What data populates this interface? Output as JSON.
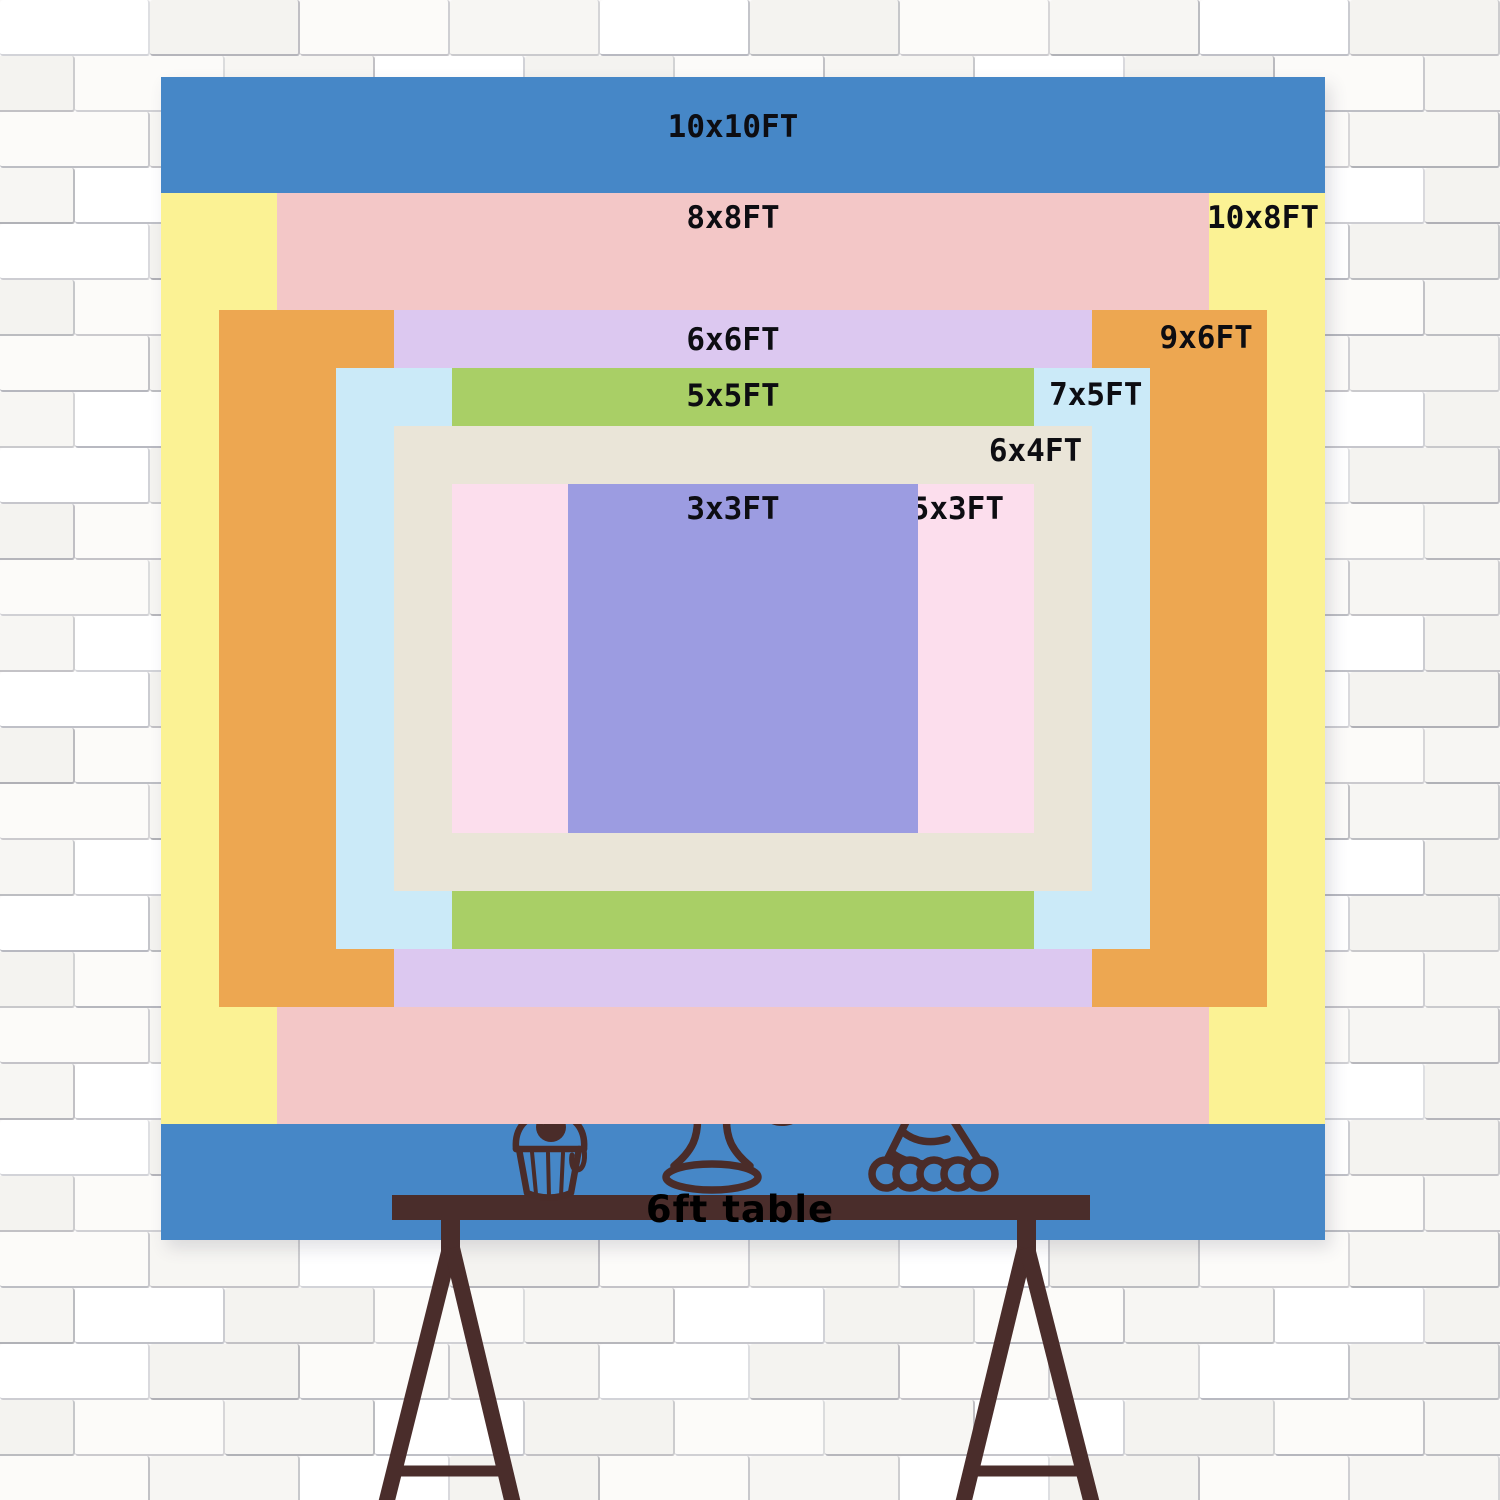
{
  "backdrop": {
    "label_color": "#0d0d12",
    "sizes": [
      {
        "id": "10x10",
        "label": "10x10FT",
        "width_ft": 10,
        "height_ft": 10,
        "color": "#4687c7",
        "label_pos": "center"
      },
      {
        "id": "10x8",
        "label": "10x8FT",
        "width_ft": 10,
        "height_ft": 8,
        "color": "#fbf294",
        "label_pos": "right"
      },
      {
        "id": "8x8",
        "label": "8x8FT",
        "width_ft": 8,
        "height_ft": 8,
        "color": "#f3c7c7",
        "label_pos": "center"
      },
      {
        "id": "9x6",
        "label": "9x6FT",
        "width_ft": 9,
        "height_ft": 6,
        "color": "#eda751",
        "label_pos": "right"
      },
      {
        "id": "6x6",
        "label": "6x6FT",
        "width_ft": 6,
        "height_ft": 6,
        "color": "#dcc8f0",
        "label_pos": "center"
      },
      {
        "id": "7x5",
        "label": "7x5FT",
        "width_ft": 7,
        "height_ft": 5,
        "color": "#cbeaf8",
        "label_pos": "right"
      },
      {
        "id": "5x5",
        "label": "5x5FT",
        "width_ft": 5,
        "height_ft": 5,
        "color": "#a9cf66",
        "label_pos": "center"
      },
      {
        "id": "6x4",
        "label": "6x4FT",
        "width_ft": 6,
        "height_ft": 4,
        "color": "#eae5d8",
        "label_pos": "right"
      },
      {
        "id": "5x3",
        "label": "5x3FT",
        "width_ft": 5,
        "height_ft": 3,
        "color": "#fcdeed",
        "label_pos": "right"
      },
      {
        "id": "3x3",
        "label": "3x3FT",
        "width_ft": 3,
        "height_ft": 3,
        "color": "#9c9ce1",
        "label_pos": "center"
      }
    ]
  },
  "table": {
    "label": "6ft table",
    "text_color": "#000000",
    "wood_color": "#4a2d2b"
  },
  "artwork": {
    "line_color": "#4a2c29",
    "items": [
      "birthday-cake-icon",
      "cupcake-icon",
      "party-hat-icon"
    ]
  },
  "wall": {
    "brick_shades": [
      "#ffffff",
      "#f7f6f3",
      "#fcfbf9",
      "#f4f3f0"
    ]
  }
}
